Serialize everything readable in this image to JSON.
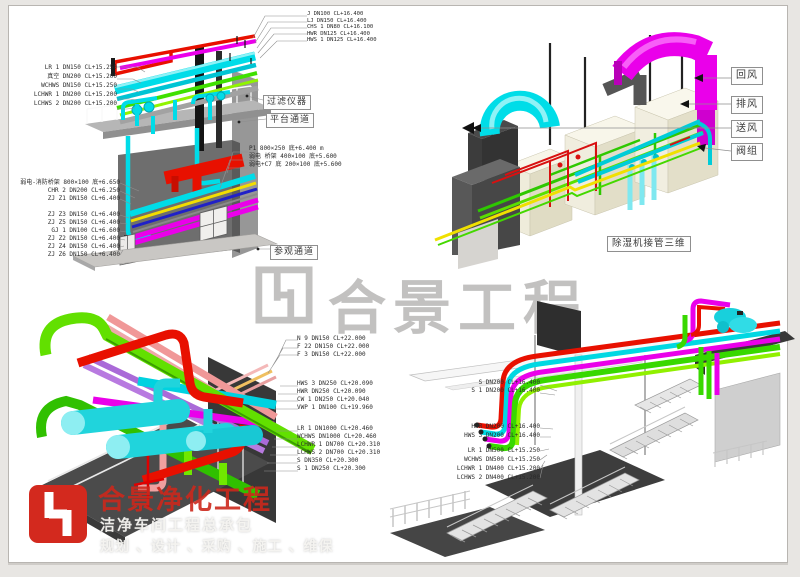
{
  "watermark": {
    "text": "合景工程"
  },
  "branding": {
    "company": "合景净化工程",
    "line1": "洁净车间工程总承包",
    "line2": "规划 、设计 、采购 、施工 、维保",
    "accent_color": "#d3291e"
  },
  "views": {
    "v1": {
      "boxes": {
        "filter": "过滤仪器",
        "platform": "平台通道",
        "visit": "参观通道"
      },
      "labels_top": [
        "J DN100 CL+16.400",
        "LJ DN150 CL+16.400",
        "CHS 1 DN80 CL+16.100",
        "HWR DN125 CL+16.400",
        "HWS 1 DN125 CL+16.400"
      ],
      "labels_left_upper": [
        "LR 1 DN150 CL+15.250",
        "真空 DN200 CL+15.200",
        "WCHWS DN150 CL+15.250",
        "LCHWR 1 DN200 CL+15.200",
        "LCHWS 2 DN200 CL+15.200"
      ],
      "labels_right_mid": [
        "P1 800×250 底+6.400 m",
        "弱电 桥架 400×100 底+5.600",
        "弱电+C7 底 200×100 底+5.600"
      ],
      "labels_left_lower": [
        "弱电-消防桥架 800×100 底+6.650",
        "CHR 2 DN200 CL+6.250",
        "ZJ Z1 DN150 CL+6.400",
        "ZJ Z3 DN150 CL+6.400",
        "ZJ Z5 DN150 CL+6.400",
        "GJ 1 DN100 CL+6.600",
        "ZJ Z2 DN150 CL+6.400",
        "ZJ Z4 DN150 CL+6.400",
        "ZJ Z6 DN150 CL+6.400"
      ]
    },
    "v2": {
      "caption": "除湿机接管三维",
      "flow_labels": [
        "回风",
        "排风",
        "送风",
        "阀组"
      ]
    },
    "v3": {
      "labels_top": [
        "N 9 DN150 CL+22.000",
        "F 22 DN150 CL+22.000",
        "F 3 DN150 CL+22.000"
      ],
      "labels_mid": [
        "HWS 3 DN250 CL+20.090",
        "HWR DN250 CL+20.090",
        "CW 1 DN250 CL+20.040",
        "VWP 1 DN100 CL+19.960"
      ],
      "labels_low": [
        "LR 1 DN1000 CL+20.460",
        "WCHWS DN1000 CL+20.460",
        "LCHWR 1 DN700 CL+20.310",
        "LCHWS 2 DN700 CL+20.310",
        "S DN350 CL+20.300",
        "S 1 DN250 CL+20.300"
      ]
    },
    "v4": {
      "labels_a": [
        "S DN200 CL+16.400",
        "S 1 DN200 CL+16.400"
      ],
      "labels_b": [
        "HWR DN200 CL+16.400",
        "HWS 3 DN200 CL+16.400"
      ],
      "labels_c": [
        "LR 1 DN500 CL+15.250",
        "WCHWS DN500 CL+15.250",
        "LCHWR 1 DN400 CL+15.200",
        "LCHWS 2 DN400 CL+15.200"
      ]
    }
  }
}
